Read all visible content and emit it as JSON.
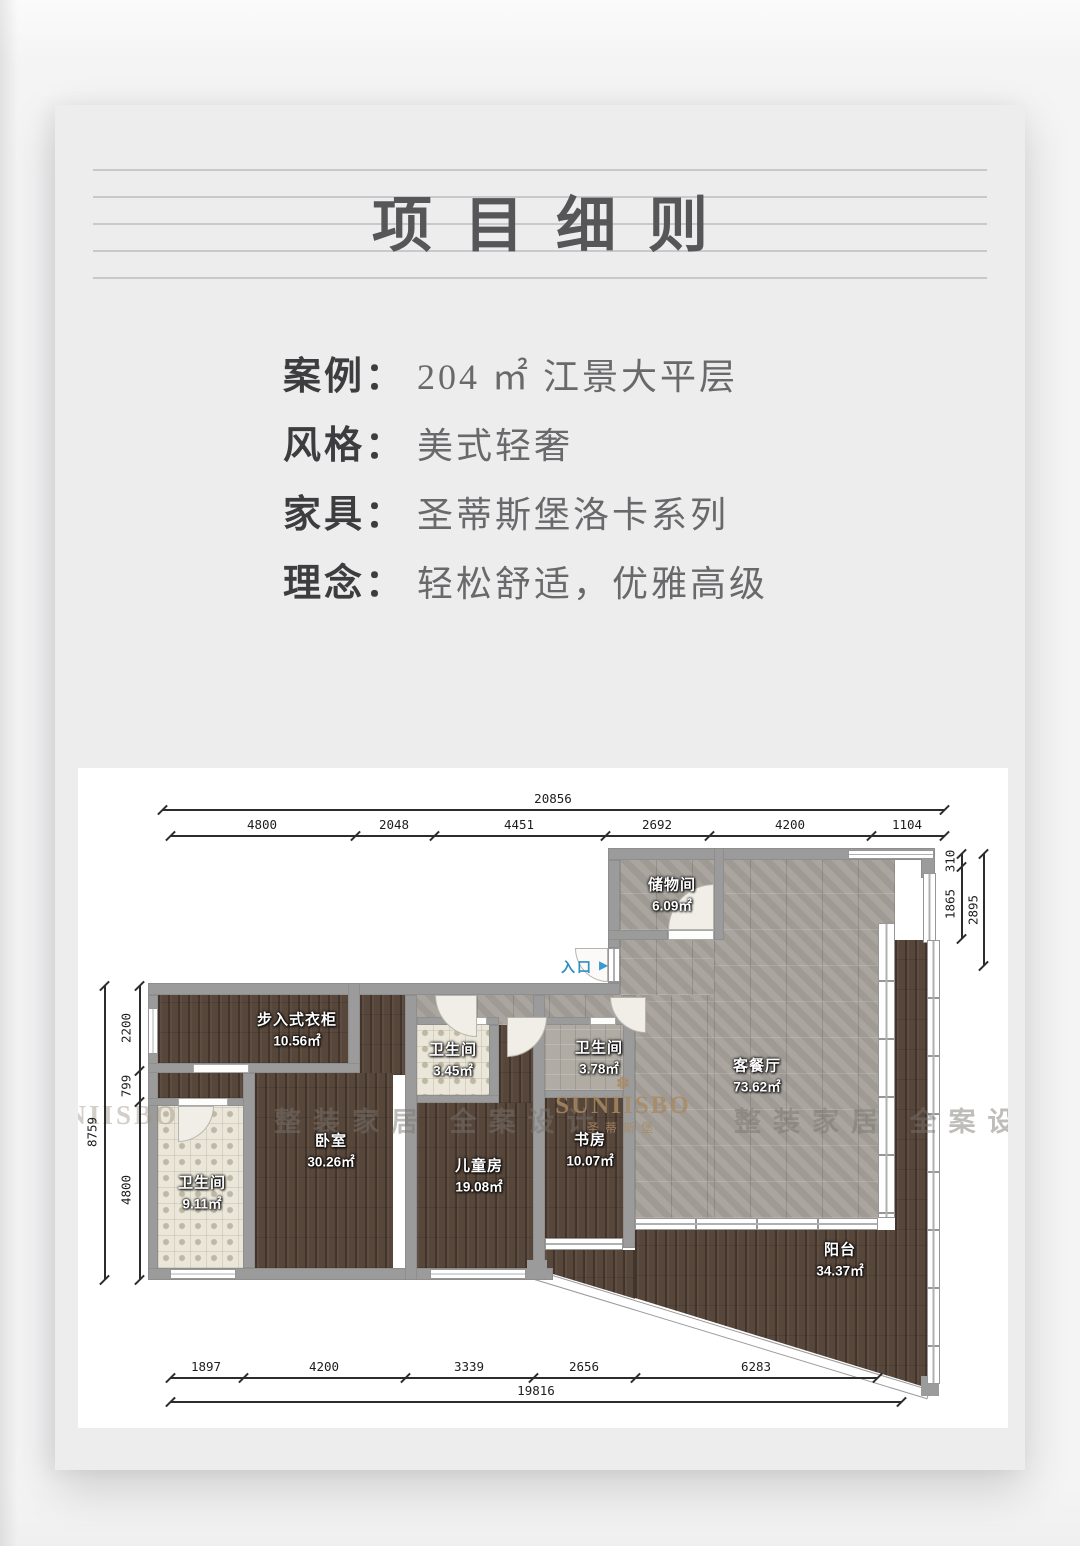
{
  "page": {
    "title": "项目细则"
  },
  "info": {
    "rows": [
      {
        "label": "案例",
        "colon": "：",
        "value": "204 ㎡ 江景大平层"
      },
      {
        "label": "风格",
        "colon": "：",
        "value": "美式轻奢"
      },
      {
        "label": "家具",
        "colon": "：",
        "value": "圣蒂斯堡洛卡系列"
      },
      {
        "label": "理念",
        "colon": "：",
        "value": "轻松舒适，优雅高级"
      }
    ]
  },
  "floorplan": {
    "entrance_label": "入口",
    "entrance_arrow": "▶",
    "rooms": [
      {
        "name": "储物间",
        "area": "6.09㎡"
      },
      {
        "name": "客餐厅",
        "area": "73.62㎡"
      },
      {
        "name": "步入式衣柜",
        "area": "10.56㎡"
      },
      {
        "name": "卫生间",
        "area": "9.11㎡"
      },
      {
        "name": "卧室",
        "area": "30.26㎡"
      },
      {
        "name": "卫生间",
        "area": "3.45㎡"
      },
      {
        "name": "儿童房",
        "area": "19.08㎡"
      },
      {
        "name": "卫生间",
        "area": "3.78㎡"
      },
      {
        "name": "书房",
        "area": "10.07㎡"
      },
      {
        "name": "阳台",
        "area": "34.37㎡"
      }
    ],
    "dimensions": {
      "top_total": "20856",
      "top_segments": [
        "4800",
        "2048",
        "4451",
        "2692",
        "4200",
        "1104"
      ],
      "left_total": "8759",
      "left_segments": [
        "2200",
        "799",
        "4800"
      ],
      "right_total": "2895",
      "right_segments": [
        "310",
        "1865"
      ],
      "bottom_total": "19816",
      "bottom_segments": [
        "1897",
        "4200",
        "3339",
        "2656",
        "6283"
      ]
    },
    "watermarks": {
      "left_brand": "SUNIISBO",
      "left_text": "整装家居 全案设计",
      "center_flower": "✽",
      "center_brand": "SUNIISBO",
      "center_sub": "圣蒂斯堡",
      "right_text": "整装家居 全案设计"
    },
    "colors": {
      "entrance_blue": "#3b9bd1",
      "wood": "#57463a",
      "tile_gray": "#a5a09a",
      "wall_gray": "#9b9b9b"
    }
  }
}
